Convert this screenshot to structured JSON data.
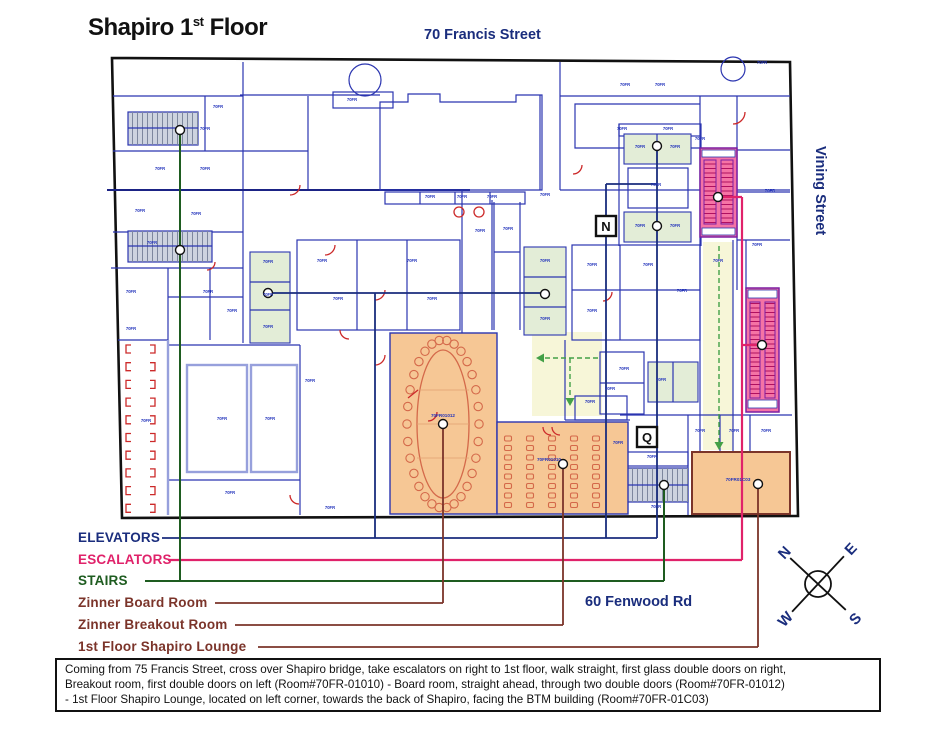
{
  "title": {
    "prefix": "Shapiro 1",
    "sup": "st",
    "suffix": " Floor"
  },
  "streets": {
    "top": "70 Francis Street",
    "right": "Vining Street",
    "bottom": "60 Fenwood Rd"
  },
  "legend": {
    "items": [
      {
        "label": "ELEVATORS",
        "color": "#1a2d7d"
      },
      {
        "label": "ESCALATORS",
        "color": "#e0226a"
      },
      {
        "label": "STAIRS",
        "color": "#1e5c20"
      },
      {
        "label": "Zinner Board Room",
        "color": "#7b342a"
      },
      {
        "label": "Zinner Breakout Room",
        "color": "#7b342a"
      },
      {
        "label": "1st Floor Shapiro Lounge",
        "color": "#7b342a"
      }
    ]
  },
  "markers": {
    "n": "N",
    "q": "Q"
  },
  "compass": {
    "n": "N",
    "e": "E",
    "s": "S",
    "w": "W"
  },
  "rooms": {
    "board": {
      "label": "70FR01012"
    },
    "breakout": {
      "label": "70FR01010"
    },
    "lounge": {
      "label": "70FR01C03"
    }
  },
  "micro_label": "70FR",
  "micro_positions": [
    [
      160,
      170
    ],
    [
      205,
      170
    ],
    [
      140,
      212
    ],
    [
      196,
      215
    ],
    [
      152,
      244
    ],
    [
      131,
      293
    ],
    [
      146,
      422
    ],
    [
      131,
      330
    ],
    [
      208,
      293
    ],
    [
      232,
      312
    ],
    [
      268,
      263
    ],
    [
      268,
      296
    ],
    [
      268,
      328
    ],
    [
      322,
      262
    ],
    [
      338,
      300
    ],
    [
      412,
      262
    ],
    [
      432,
      300
    ],
    [
      480,
      232
    ],
    [
      508,
      230
    ],
    [
      545,
      262
    ],
    [
      545,
      320
    ],
    [
      592,
      266
    ],
    [
      592,
      312
    ],
    [
      648,
      266
    ],
    [
      682,
      292
    ],
    [
      430,
      198
    ],
    [
      462,
      198
    ],
    [
      492,
      198
    ],
    [
      545,
      196
    ],
    [
      352,
      101
    ],
    [
      625,
      86
    ],
    [
      660,
      86
    ],
    [
      622,
      130
    ],
    [
      668,
      130
    ],
    [
      640,
      148
    ],
    [
      675,
      148
    ],
    [
      640,
      227
    ],
    [
      675,
      227
    ],
    [
      656,
      186
    ],
    [
      700,
      140
    ],
    [
      718,
      262
    ],
    [
      757,
      246
    ],
    [
      770,
      192
    ],
    [
      762,
      64
    ],
    [
      230,
      494
    ],
    [
      330,
      509
    ],
    [
      618,
      444
    ],
    [
      652,
      458
    ],
    [
      700,
      432
    ],
    [
      734,
      432
    ],
    [
      766,
      432
    ],
    [
      656,
      508
    ],
    [
      610,
      390
    ],
    [
      624,
      370
    ],
    [
      661,
      381
    ],
    [
      590,
      403
    ],
    [
      310,
      382
    ],
    [
      270,
      420
    ],
    [
      222,
      420
    ],
    [
      205,
      130
    ],
    [
      218,
      108
    ]
  ],
  "description": {
    "lines": [
      "Coming from 75 Francis Street, cross over Shapiro bridge, take escalators on right to 1st floor, walk straight, first glass double doors on right,",
      "Breakout room, first double doors on left (Room#70FR-01010)  - Board room, straight ahead, through two double doors (Room#70FR-01012)",
      "- 1st Floor Shapiro Lounge, located on left corner, towards the back of Shapiro, facing the BTM building (Room#70FR-01C03)"
    ]
  },
  "colors": {
    "navy": "#1a2d7d",
    "pink": "#e0226a",
    "green": "#1e5c20",
    "maroon": "#7b342a",
    "wall": "#2b35b0",
    "orange": "#f6c795",
    "roomgreen": "#e3edd7",
    "escalator": "#f573a5"
  }
}
